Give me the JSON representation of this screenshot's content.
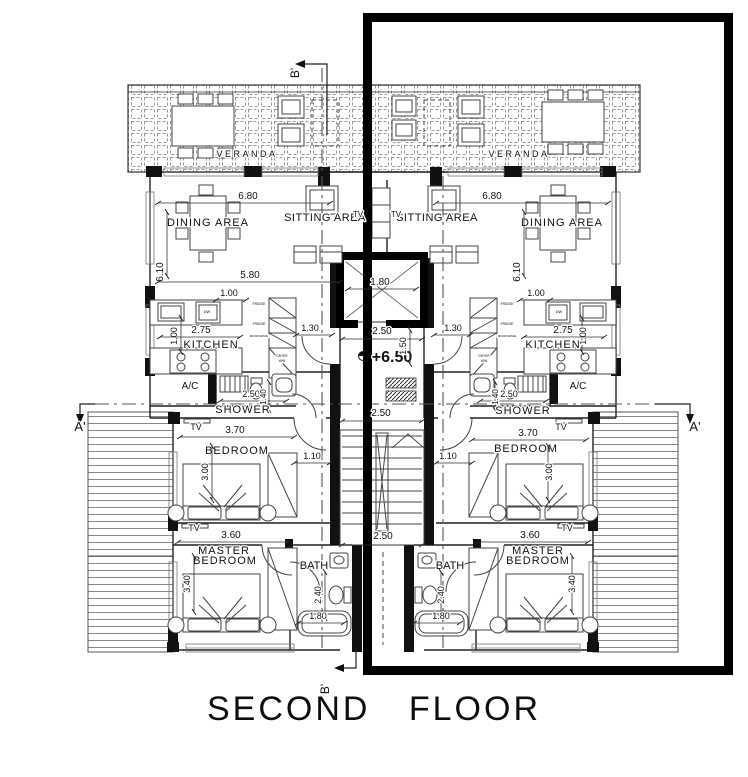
{
  "title": {
    "text": "SECOND FLOOR"
  },
  "palette": {
    "line": "#222222",
    "wall": "#111111",
    "highlight": "#000000",
    "dash": "#555555",
    "tile": "#999999"
  },
  "labels": [
    {
      "id": "veranda-left",
      "t": "VERANDA",
      "x": 247,
      "y": 157,
      "s": 9,
      "ls": 2.5
    },
    {
      "id": "veranda-right",
      "t": "VERANDA",
      "x": 519,
      "y": 157,
      "s": 9,
      "ls": 2.5
    },
    {
      "id": "dim-680-left",
      "t": "6.80",
      "x": 248,
      "y": 199,
      "s": 10,
      "line": [
        158,
        203,
        330,
        203
      ]
    },
    {
      "id": "dim-680-right",
      "t": "6.80",
      "x": 492,
      "y": 199,
      "s": 10,
      "line": [
        436,
        203,
        608,
        203
      ]
    },
    {
      "id": "room-dining-left",
      "t": "DINING  AREA",
      "x": 208,
      "y": 226,
      "s": 11,
      "ls": 1
    },
    {
      "id": "room-sitting-left",
      "t": "SITTING AREA",
      "x": 325,
      "y": 221,
      "s": 11,
      "ls": 0.5
    },
    {
      "id": "room-sitting-right",
      "t": "SITTING AREA",
      "x": 437,
      "y": 221,
      "s": 11,
      "ls": 0.5
    },
    {
      "id": "room-dining-right",
      "t": "DINING  AREA",
      "x": 562,
      "y": 226,
      "s": 11,
      "ls": 1
    },
    {
      "id": "tv-sitting-left",
      "t": "TV",
      "x": 358,
      "y": 217,
      "s": 8
    },
    {
      "id": "tv-sitting-right",
      "t": "TV",
      "x": 396,
      "y": 217,
      "s": 8
    },
    {
      "id": "dim-610-left",
      "t": "6.10",
      "x": 163,
      "y": 272,
      "s": 10,
      "r": -90,
      "line": [
        167,
        212,
        167,
        276
      ]
    },
    {
      "id": "dim-610-right",
      "t": "6.10",
      "x": 520,
      "y": 272,
      "s": 10,
      "r": -90,
      "line": [
        524,
        212,
        524,
        276
      ]
    },
    {
      "id": "dim-580",
      "t": "5.80",
      "x": 250,
      "y": 278,
      "s": 10,
      "line": [
        158,
        282,
        340,
        282
      ]
    },
    {
      "id": "dim-100-left-h",
      "t": "1.00",
      "x": 229,
      "y": 296,
      "s": 9,
      "line": [
        216,
        300,
        246,
        300
      ]
    },
    {
      "id": "dim-100-right-h",
      "t": "1.00",
      "x": 536,
      "y": 296,
      "s": 9,
      "line": [
        520,
        300,
        550,
        300
      ]
    },
    {
      "id": "dim-100-left-v",
      "t": "1.00",
      "x": 177,
      "y": 336,
      "s": 9,
      "r": -90,
      "line": [
        181,
        318,
        181,
        352
      ]
    },
    {
      "id": "dim-100-right-v",
      "t": "1.00",
      "x": 586,
      "y": 336,
      "s": 9,
      "r": -90,
      "line": [
        582,
        318,
        582,
        352
      ]
    },
    {
      "id": "dim-275-left",
      "t": "2.75",
      "x": 201,
      "y": 333,
      "s": 10,
      "line": [
        160,
        337,
        240,
        337
      ]
    },
    {
      "id": "dim-275-right",
      "t": "2.75",
      "x": 563,
      "y": 333,
      "s": 10,
      "line": [
        524,
        337,
        604,
        337
      ]
    },
    {
      "id": "room-kitchen-left",
      "t": "KITCHEN",
      "x": 211,
      "y": 348,
      "s": 11,
      "ls": 1
    },
    {
      "id": "room-kitchen-right",
      "t": "KITCHEN",
      "x": 553,
      "y": 348,
      "s": 11,
      "ls": 1
    },
    {
      "id": "dim-130-left",
      "t": "1.30",
      "x": 310,
      "y": 331,
      "s": 9,
      "line": [
        296,
        335,
        332,
        335
      ]
    },
    {
      "id": "dim-130-right",
      "t": "1.30",
      "x": 453,
      "y": 331,
      "s": 9,
      "line": [
        434,
        335,
        470,
        335
      ]
    },
    {
      "id": "dim-180-elevator",
      "t": "1.80",
      "x": 380,
      "y": 285,
      "s": 10,
      "line": [
        348,
        289,
        416,
        289
      ]
    },
    {
      "id": "dim-250-core-top",
      "t": "2.50",
      "x": 382,
      "y": 334,
      "s": 10,
      "line": [
        342,
        339,
        422,
        339
      ]
    },
    {
      "id": "level-value",
      "t": "+6.50",
      "x": 392,
      "y": 362,
      "s": 16,
      "b": 1
    },
    {
      "id": "dim-150-core",
      "t": "1.50",
      "x": 406,
      "y": 346,
      "s": 9,
      "r": -90,
      "line": [
        410,
        330,
        410,
        364
      ]
    },
    {
      "id": "dim-250-core-mid",
      "t": "2.50",
      "x": 381,
      "y": 416,
      "s": 10,
      "line": [
        342,
        421,
        422,
        421
      ]
    },
    {
      "id": "dim-250-stairs",
      "t": "2.50",
      "x": 383,
      "y": 539,
      "s": 10,
      "line": [
        342,
        545,
        422,
        545
      ]
    },
    {
      "id": "room-ac-left",
      "t": "A/C",
      "x": 190,
      "y": 389,
      "s": 10
    },
    {
      "id": "room-ac-right",
      "t": "A/C",
      "x": 578,
      "y": 389,
      "s": 10
    },
    {
      "id": "dim-250-shower-left",
      "t": "2.50",
      "x": 251,
      "y": 397,
      "s": 9,
      "line": [
        220,
        401,
        286,
        401
      ]
    },
    {
      "id": "dim-250-shower-right",
      "t": "2.50",
      "x": 509,
      "y": 397,
      "s": 9,
      "line": [
        480,
        401,
        546,
        401
      ]
    },
    {
      "id": "dim-140-left",
      "t": "1.40",
      "x": 266,
      "y": 397,
      "s": 8,
      "r": -90,
      "line": [
        269,
        382,
        269,
        410
      ]
    },
    {
      "id": "dim-140-right",
      "t": "1.40",
      "x": 498,
      "y": 397,
      "s": 8,
      "r": -90,
      "line": [
        495,
        382,
        495,
        410
      ]
    },
    {
      "id": "room-shower-left",
      "t": "SHOWER",
      "x": 243,
      "y": 413,
      "s": 11,
      "ls": 1
    },
    {
      "id": "room-shower-right",
      "t": "SHOWER",
      "x": 523,
      "y": 414,
      "s": 11,
      "ls": 1
    },
    {
      "id": "tv-bed-left",
      "t": "TV",
      "x": 196,
      "y": 430,
      "s": 9
    },
    {
      "id": "tv-bed-right",
      "t": "TV",
      "x": 561,
      "y": 430,
      "s": 9
    },
    {
      "id": "dim-370-left",
      "t": "3.70",
      "x": 235,
      "y": 433,
      "s": 10,
      "line": [
        180,
        437,
        294,
        437
      ]
    },
    {
      "id": "dim-370-right",
      "t": "3.70",
      "x": 528,
      "y": 436,
      "s": 10,
      "line": [
        472,
        440,
        586,
        440
      ]
    },
    {
      "id": "room-bedroom-left",
      "t": "BEDROOM",
      "x": 237,
      "y": 454,
      "s": 11,
      "ls": 1
    },
    {
      "id": "room-bedroom-right",
      "t": "BEDROOM",
      "x": 526,
      "y": 452,
      "s": 11,
      "ls": 1
    },
    {
      "id": "dim-300-left",
      "t": "3.00",
      "x": 208,
      "y": 472,
      "s": 9,
      "r": -90,
      "line": [
        212,
        446,
        212,
        500
      ]
    },
    {
      "id": "dim-300-right",
      "t": "3.00",
      "x": 552,
      "y": 472,
      "s": 9,
      "r": -90,
      "line": [
        548,
        446,
        548,
        500
      ]
    },
    {
      "id": "dim-110-left",
      "t": "1.10",
      "x": 312,
      "y": 459,
      "s": 9,
      "line": [
        294,
        463,
        330,
        463
      ]
    },
    {
      "id": "dim-110-right",
      "t": "1.10",
      "x": 448,
      "y": 459,
      "s": 9,
      "line": [
        436,
        463,
        472,
        463
      ]
    },
    {
      "id": "tv-master-left",
      "t": "TV",
      "x": 194,
      "y": 531,
      "s": 9
    },
    {
      "id": "tv-master-right",
      "t": "TV",
      "x": 567,
      "y": 531,
      "s": 9
    },
    {
      "id": "dim-360-left",
      "t": "3.60",
      "x": 231,
      "y": 538,
      "s": 10,
      "line": [
        178,
        542,
        288,
        542
      ]
    },
    {
      "id": "dim-360-right",
      "t": "3.60",
      "x": 530,
      "y": 538,
      "s": 10,
      "line": [
        478,
        542,
        588,
        542
      ]
    },
    {
      "id": "room-master-left-1",
      "t": "MASTER",
      "x": 224,
      "y": 554,
      "s": 11,
      "ls": 1
    },
    {
      "id": "room-master-left-2",
      "t": "BEDROOM",
      "x": 225,
      "y": 564,
      "s": 11,
      "ls": 1
    },
    {
      "id": "room-master-right-1",
      "t": "MASTER",
      "x": 538,
      "y": 554,
      "s": 11,
      "ls": 1
    },
    {
      "id": "room-master-right-2",
      "t": "BEDROOM",
      "x": 538,
      "y": 564,
      "s": 11,
      "ls": 1
    },
    {
      "id": "dim-340-left",
      "t": "3.40",
      "x": 190,
      "y": 584,
      "s": 9,
      "r": -90,
      "line": [
        194,
        556,
        194,
        612
      ]
    },
    {
      "id": "dim-340-right",
      "t": "3.40",
      "x": 575,
      "y": 584,
      "s": 9,
      "r": -90,
      "line": [
        572,
        556,
        572,
        612
      ]
    },
    {
      "id": "room-bath-left",
      "t": "BATH",
      "x": 314,
      "y": 569,
      "s": 11
    },
    {
      "id": "room-bath-right",
      "t": "BATH",
      "x": 450,
      "y": 569,
      "s": 11
    },
    {
      "id": "dim-240-left",
      "t": "2.40",
      "x": 321,
      "y": 595,
      "s": 9,
      "r": -90,
      "line": [
        325,
        572,
        325,
        618
      ]
    },
    {
      "id": "dim-240-right",
      "t": "2.40",
      "x": 444,
      "y": 595,
      "s": 9,
      "r": -90,
      "line": [
        441,
        572,
        441,
        618
      ]
    },
    {
      "id": "dim-180-bath-left",
      "t": "1.80",
      "x": 318,
      "y": 619,
      "s": 9,
      "line": [
        298,
        623,
        344,
        623
      ]
    },
    {
      "id": "dim-180-bath-right",
      "t": "1.80",
      "x": 441,
      "y": 619,
      "s": 9,
      "line": [
        414,
        623,
        460,
        623
      ]
    },
    {
      "id": "marker-b-top",
      "t": "B'",
      "x": 299,
      "y": 73,
      "s": 12,
      "r": -90
    },
    {
      "id": "marker-b-bottom",
      "t": "B'",
      "x": 329,
      "y": 689,
      "s": 12,
      "r": -90
    },
    {
      "id": "marker-a-left",
      "t": "A'",
      "x": 80,
      "y": 431,
      "s": 13
    },
    {
      "id": "marker-a-right",
      "t": "A'",
      "x": 695,
      "y": 431,
      "s": 13
    },
    {
      "id": "appl-fridge-l1",
      "t": "FRIDGE",
      "x": 259,
      "y": 305,
      "s": 3.4
    },
    {
      "id": "appl-fridge-l2",
      "t": "FRIDGE",
      "x": 259,
      "y": 325,
      "s": 3.4
    },
    {
      "id": "appl-micro-l",
      "t": "MICROWAVE",
      "x": 259,
      "y": 337,
      "s": 3
    },
    {
      "id": "appl-dryer-l1",
      "t": "DRYER",
      "x": 282,
      "y": 357,
      "s": 3.2
    },
    {
      "id": "appl-dryer-l2",
      "t": "W/M",
      "x": 282,
      "y": 362,
      "s": 3.2
    },
    {
      "id": "appl-dw-l",
      "t": "DW",
      "x": 207,
      "y": 313,
      "s": 4
    },
    {
      "id": "appl-fridge-r1",
      "t": "FRIDGE",
      "x": 507,
      "y": 305,
      "s": 3.4
    },
    {
      "id": "appl-fridge-r2",
      "t": "FRIDGE",
      "x": 507,
      "y": 325,
      "s": 3.4
    },
    {
      "id": "appl-micro-r",
      "t": "MICROWAVE",
      "x": 507,
      "y": 337,
      "s": 3
    },
    {
      "id": "appl-dryer-r1",
      "t": "DRYER",
      "x": 484,
      "y": 357,
      "s": 3.2
    },
    {
      "id": "appl-dryer-r2",
      "t": "W/M",
      "x": 484,
      "y": 362,
      "s": 3.2
    },
    {
      "id": "appl-dw-r",
      "t": "DW",
      "x": 559,
      "y": 313,
      "s": 4
    }
  ]
}
